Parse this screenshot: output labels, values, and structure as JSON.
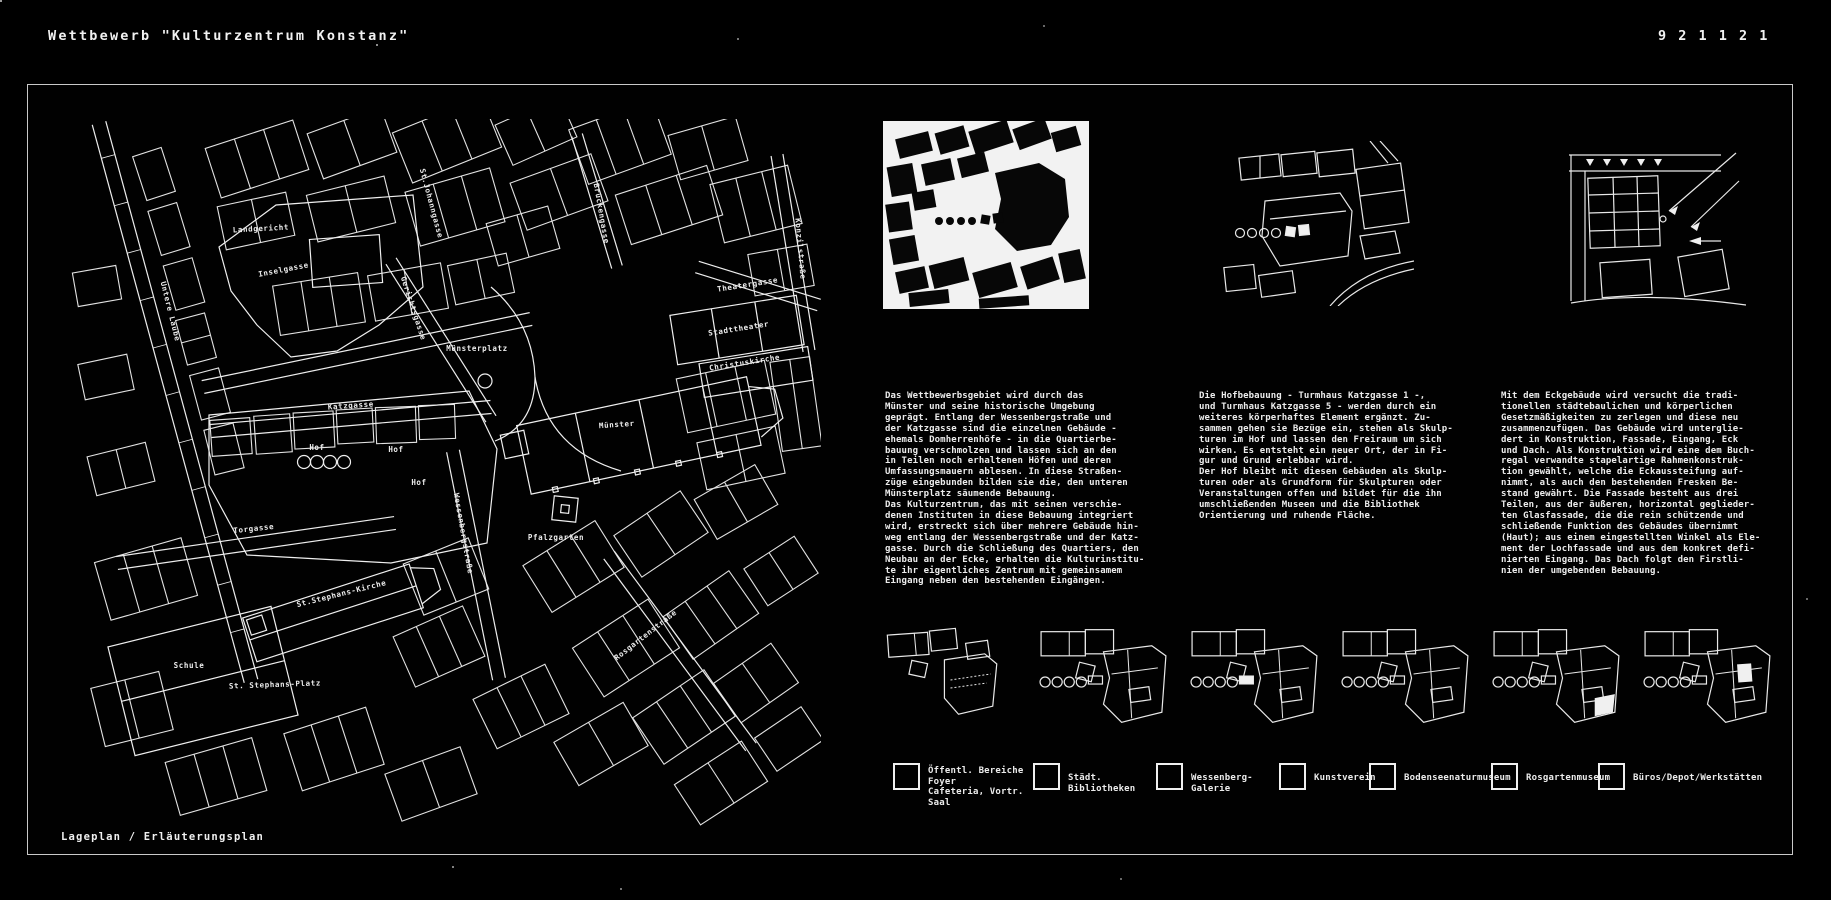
{
  "page": {
    "title": "Wettbewerb \"Kulturzentrum Konstanz\"",
    "sheet_number": "9 2 1 1 2 1",
    "caption": "Lageplan / Erläuterungsplan"
  },
  "map_labels": [
    {
      "text": "Landgericht",
      "x": 200,
      "y": 112,
      "rot": -3
    },
    {
      "text": "Inselgasse",
      "x": 223,
      "y": 153,
      "rot": -11
    },
    {
      "text": "St.Johanngasse",
      "x": 368,
      "y": 85,
      "rot": 75
    },
    {
      "text": "Gerichtsgasse",
      "x": 350,
      "y": 190,
      "rot": 72
    },
    {
      "text": "Brückengasse",
      "x": 538,
      "y": 95,
      "rot": 80
    },
    {
      "text": "Konzilstraße",
      "x": 737,
      "y": 130,
      "rot": 85
    },
    {
      "text": "Theatergasse",
      "x": 687,
      "y": 168,
      "rot": -9
    },
    {
      "text": "Stadttheater",
      "x": 678,
      "y": 212,
      "rot": -9
    },
    {
      "text": "Christuskirche",
      "x": 684,
      "y": 246,
      "rot": -9
    },
    {
      "text": "Untere Laube",
      "x": 107,
      "y": 193,
      "rot": 76
    },
    {
      "text": "Münsterplatz",
      "x": 416,
      "y": 232,
      "rot": 0
    },
    {
      "text": "Katzgasse",
      "x": 290,
      "y": 289,
      "rot": -4
    },
    {
      "text": "Hof",
      "x": 256,
      "y": 331,
      "rot": 0
    },
    {
      "text": "Hof",
      "x": 335,
      "y": 333,
      "rot": 0
    },
    {
      "text": "Hof",
      "x": 358,
      "y": 366,
      "rot": 0
    },
    {
      "text": "Münster",
      "x": 556,
      "y": 308,
      "rot": -4
    },
    {
      "text": "Pfalzgarten",
      "x": 495,
      "y": 421,
      "rot": 0
    },
    {
      "text": "Wessenbergstraße",
      "x": 400,
      "y": 415,
      "rot": 80
    },
    {
      "text": "Torgasse",
      "x": 193,
      "y": 412,
      "rot": -6
    },
    {
      "text": "St.Stephans-Kirche",
      "x": 281,
      "y": 477,
      "rot": -14
    },
    {
      "text": "Schule",
      "x": 128,
      "y": 549,
      "rot": 0
    },
    {
      "text": "St. Stephans-Platz",
      "x": 214,
      "y": 568,
      "rot": -2
    },
    {
      "text": "Rosgartenstraße",
      "x": 586,
      "y": 518,
      "rot": -38
    }
  ],
  "columns": [
    {
      "text": "Das Wettbewerbsgebiet wird durch das\nMünster und seine historische Umgebung\ngeprägt. Entlang der Wessenbergstraße und\nder Katzgasse sind die einzelnen Gebäude -\nehemals Domherrenhöfe - in die Quartierbe-\nbauung verschmolzen und lassen sich an den\nin Teilen noch erhaltenen Höfen und deren\nUmfassungsmauern ablesen. In diese Straßen-\nzüge eingebunden bilden sie die, den unteren\nMünsterplatz säumende Bebauung.\nDas Kulturzentrum, das mit seinen verschie-\ndenen Instituten in diese Bebauung integriert\nwird, erstreckt sich über mehrere Gebäude hin-\nweg entlang der Wessenbergstraße und der Katz-\ngasse. Durch die Schließung des Quartiers, den\nNeubau an der Ecke, erhalten die Kulturinstitu-\nte ihr eigentliches Zentrum mit gemeinsamem\nEingang neben den bestehenden Eingängen."
    },
    {
      "text": "Die Hofbebauung - Turmhaus Katzgasse 1 -,\nund Turmhaus Katzgasse 5 - werden durch ein\nweiteres körperhaftes Element ergänzt. Zu-\nsammen gehen sie Bezüge ein, stehen als Skulp-\nturen im Hof und lassen den Freiraum um sich\nwirken. Es entsteht ein neuer Ort, der in Fi-\ngur und Grund erlebbar wird.\nDer Hof bleibt mit diesen Gebäuden als Skulp-\nturen oder als Grundform für Skulpturen oder\nVeranstaltungen offen und bildet für die ihn\numschließenden Museen und die Bibliothek\nOrientierung und ruhende Fläche."
    },
    {
      "text": "Mit dem Eckgebäude wird versucht die tradi-\ntionellen städtebaulichen und körperlichen\nGesetzmäßigkeiten zu zerlegen und diese neu\nzusammenzufügen. Das Gebäude wird unterglie-\ndert in Konstruktion, Fassade, Eingang, Eck\nund Dach. Als Konstruktion wird eine dem Buch-\nregal verwandte stapelartige Rahmenkonstruk-\ntion gewählt, welche die Eckaussteifung auf-\nnimmt, als auch den bestehenden Fresken Be-\nstand gewährt. Die Fassade besteht aus drei\nTeilen, aus der äußeren, horizontal geglieder-\nten Glasfassade, die die rein schützende und\nschließende Funktion des Gebäudes übernimmt\n(Haut); aus einem eingestellten Winkel als Ele-\nment der Lochfassade und aus dem konkret defi-\nnierten Eingang. Das Dach folgt den Firstli-\nnien der umgebenden Bebauung."
    }
  ],
  "legend": {
    "items": [
      {
        "label": "Öffentl. Bereiche Foyer\nCafeteria, Vortr. Saal"
      },
      {
        "label": "Städt. Bibliotheken"
      },
      {
        "label": "Wessenberg-Galerie"
      },
      {
        "label": "Kunstverein"
      },
      {
        "label": "Bodenseenaturmuseum"
      },
      {
        "label": "Rosgartenmuseum"
      },
      {
        "label": "Büros/Depot/Werkstätten"
      }
    ]
  },
  "panels": [
    {
      "name": "figure-ground-plan"
    },
    {
      "name": "hof-plan"
    },
    {
      "name": "corner-building-detail"
    }
  ],
  "diagrams": [
    {
      "variant": "exploded"
    },
    {
      "variant": "base"
    },
    {
      "variant": "bar-filled"
    },
    {
      "variant": "base"
    },
    {
      "variant": "corner-filled"
    },
    {
      "variant": "mid-filled"
    }
  ]
}
